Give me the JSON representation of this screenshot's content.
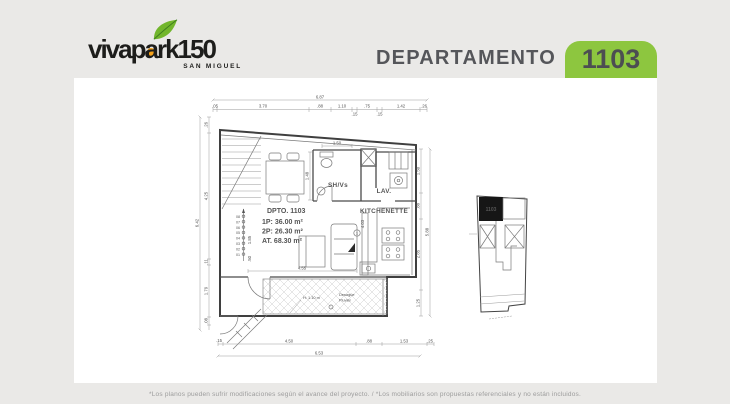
{
  "theme": {
    "bg": "#eae9e7",
    "panel": "#ffffff",
    "badge_green": "#8dc63f",
    "header_text": "#55565a",
    "logo_black": "#1d1d1b",
    "leaf_green": "#72b62c",
    "dot_orange": "#f6a118"
  },
  "logo": {
    "part1": "vivap",
    "part2": "a",
    "part3": "rk",
    "part4": "150",
    "subtitle": "SAN MIGUEL"
  },
  "header": {
    "label": "DEPARTAMENTO",
    "unit_number": "1103"
  },
  "plan": {
    "info": {
      "title": "DPTO. 1103",
      "area_1p": "1P: 36.00 m²",
      "area_2p": "2P: 26.30 m²",
      "area_total": "AT. 68.30 m²"
    },
    "labels": {
      "bathroom": "SH/Vs",
      "laundry": "LAV.",
      "kitchen": "KITCHENETTE",
      "parapet_note": "H: 1.10 m",
      "drain_line1": "Desagüe",
      "drain_line2": "Pluvial",
      "column_mark": "1"
    },
    "steps": [
      "01",
      "02",
      "03",
      "04",
      "05",
      "06",
      "07",
      "08"
    ],
    "dims": {
      "top_overall": "6.87",
      "top_segments": [
        ".05",
        "3.70",
        ".88",
        "1.10",
        ".15",
        ".75",
        ".15",
        "1.42",
        ".26"
      ],
      "left_overall": "6.42",
      "left_segments": [
        ".26",
        "4.25",
        ".11",
        "1.79",
        ".08"
      ],
      "right_overall": "5.88",
      "right_segments": [
        "1.50",
        ".88",
        "2.85",
        "1.25"
      ],
      "bottom_overall": "6.53",
      "bottom_segments": [
        ".15",
        "4.50",
        ".88",
        "1.53",
        ".25"
      ],
      "bath_width": "1.50",
      "bath_depth": "1.48",
      "living_width": "4.55",
      "stair_width": "1.85",
      "stair_landing": ".50",
      "kitchen_run": "4.03"
    }
  },
  "keyplan": {
    "unit_number": "1103"
  },
  "footer": {
    "disclaimer": "*Los planos pueden sufrir modificaciones según el avance del proyecto. / *Los mobiliarios son propuestas referenciales y no están incluidos."
  }
}
